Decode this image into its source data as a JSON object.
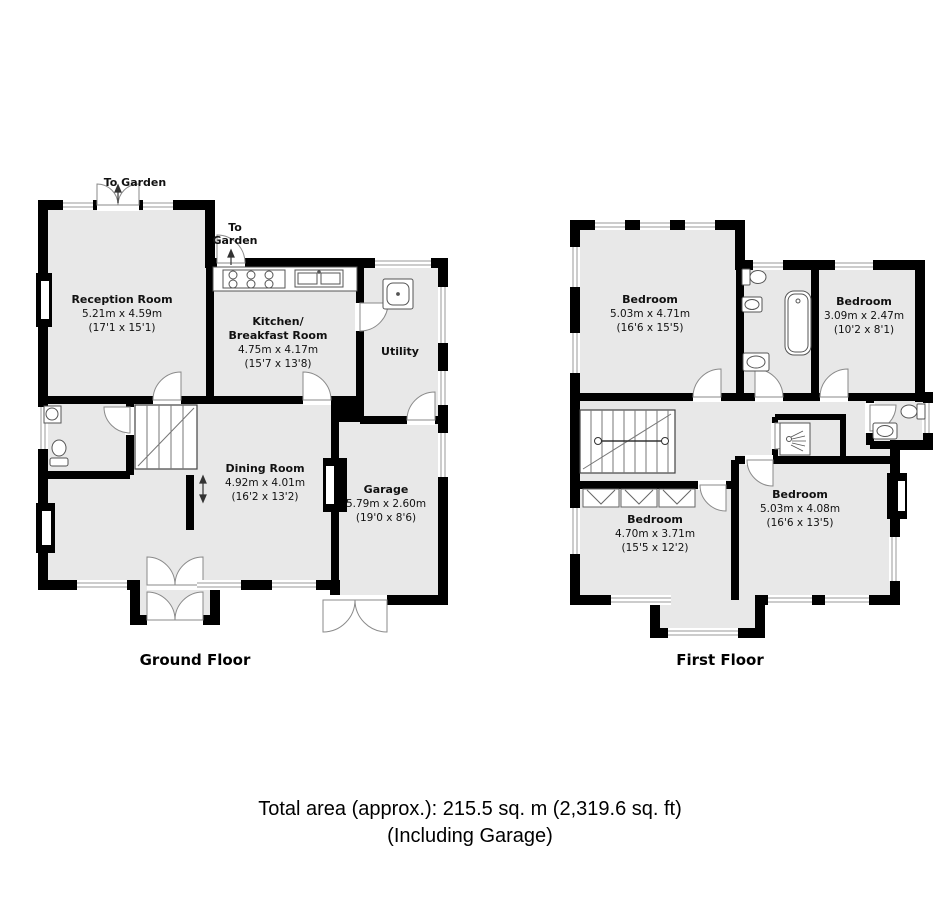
{
  "page": {
    "total_area_line1": "Total area (approx.): 215.5 sq. m (2,319.6 sq. ft)",
    "total_area_line2": "(Including Garage)"
  },
  "ground_floor": {
    "caption": "Ground Floor",
    "annotations": {
      "to_garden_top": "To Garden",
      "to_garden_kitchen_line1": "To",
      "to_garden_kitchen_line2": "Garden"
    },
    "rooms": {
      "reception": {
        "name": "Reception Room",
        "dims_m": "5.21m x 4.59m",
        "dims_ft": "(17'1 x 15'1)"
      },
      "kitchen": {
        "name_line1": "Kitchen/",
        "name_line2": "Breakfast Room",
        "dims_m": "4.75m x 4.17m",
        "dims_ft": "(15'7 x 13'8)"
      },
      "utility": {
        "name": "Utility"
      },
      "dining": {
        "name": "Dining Room",
        "dims_m": "4.92m x 4.01m",
        "dims_ft": "(16'2 x 13'2)"
      },
      "garage": {
        "name": "Garage",
        "dims_m": "5.79m x 2.60m",
        "dims_ft": "(19'0 x 8'6)"
      }
    }
  },
  "first_floor": {
    "caption": "First Floor",
    "rooms": {
      "bedroom_master": {
        "name": "Bedroom",
        "dims_m": "5.03m x 4.71m",
        "dims_ft": "(16'6 x 15'5)"
      },
      "bedroom_small": {
        "name": "Bedroom",
        "dims_m": "3.09m x 2.47m",
        "dims_ft": "(10'2 x 8'1)"
      },
      "bedroom_rear": {
        "name": "Bedroom",
        "dims_m": "4.70m x 3.71m",
        "dims_ft": "(15'5 x 12'2)"
      },
      "bedroom_front": {
        "name": "Bedroom",
        "dims_m": "5.03m x 4.08m",
        "dims_ft": "(16'6 x 13'5)"
      }
    }
  }
}
